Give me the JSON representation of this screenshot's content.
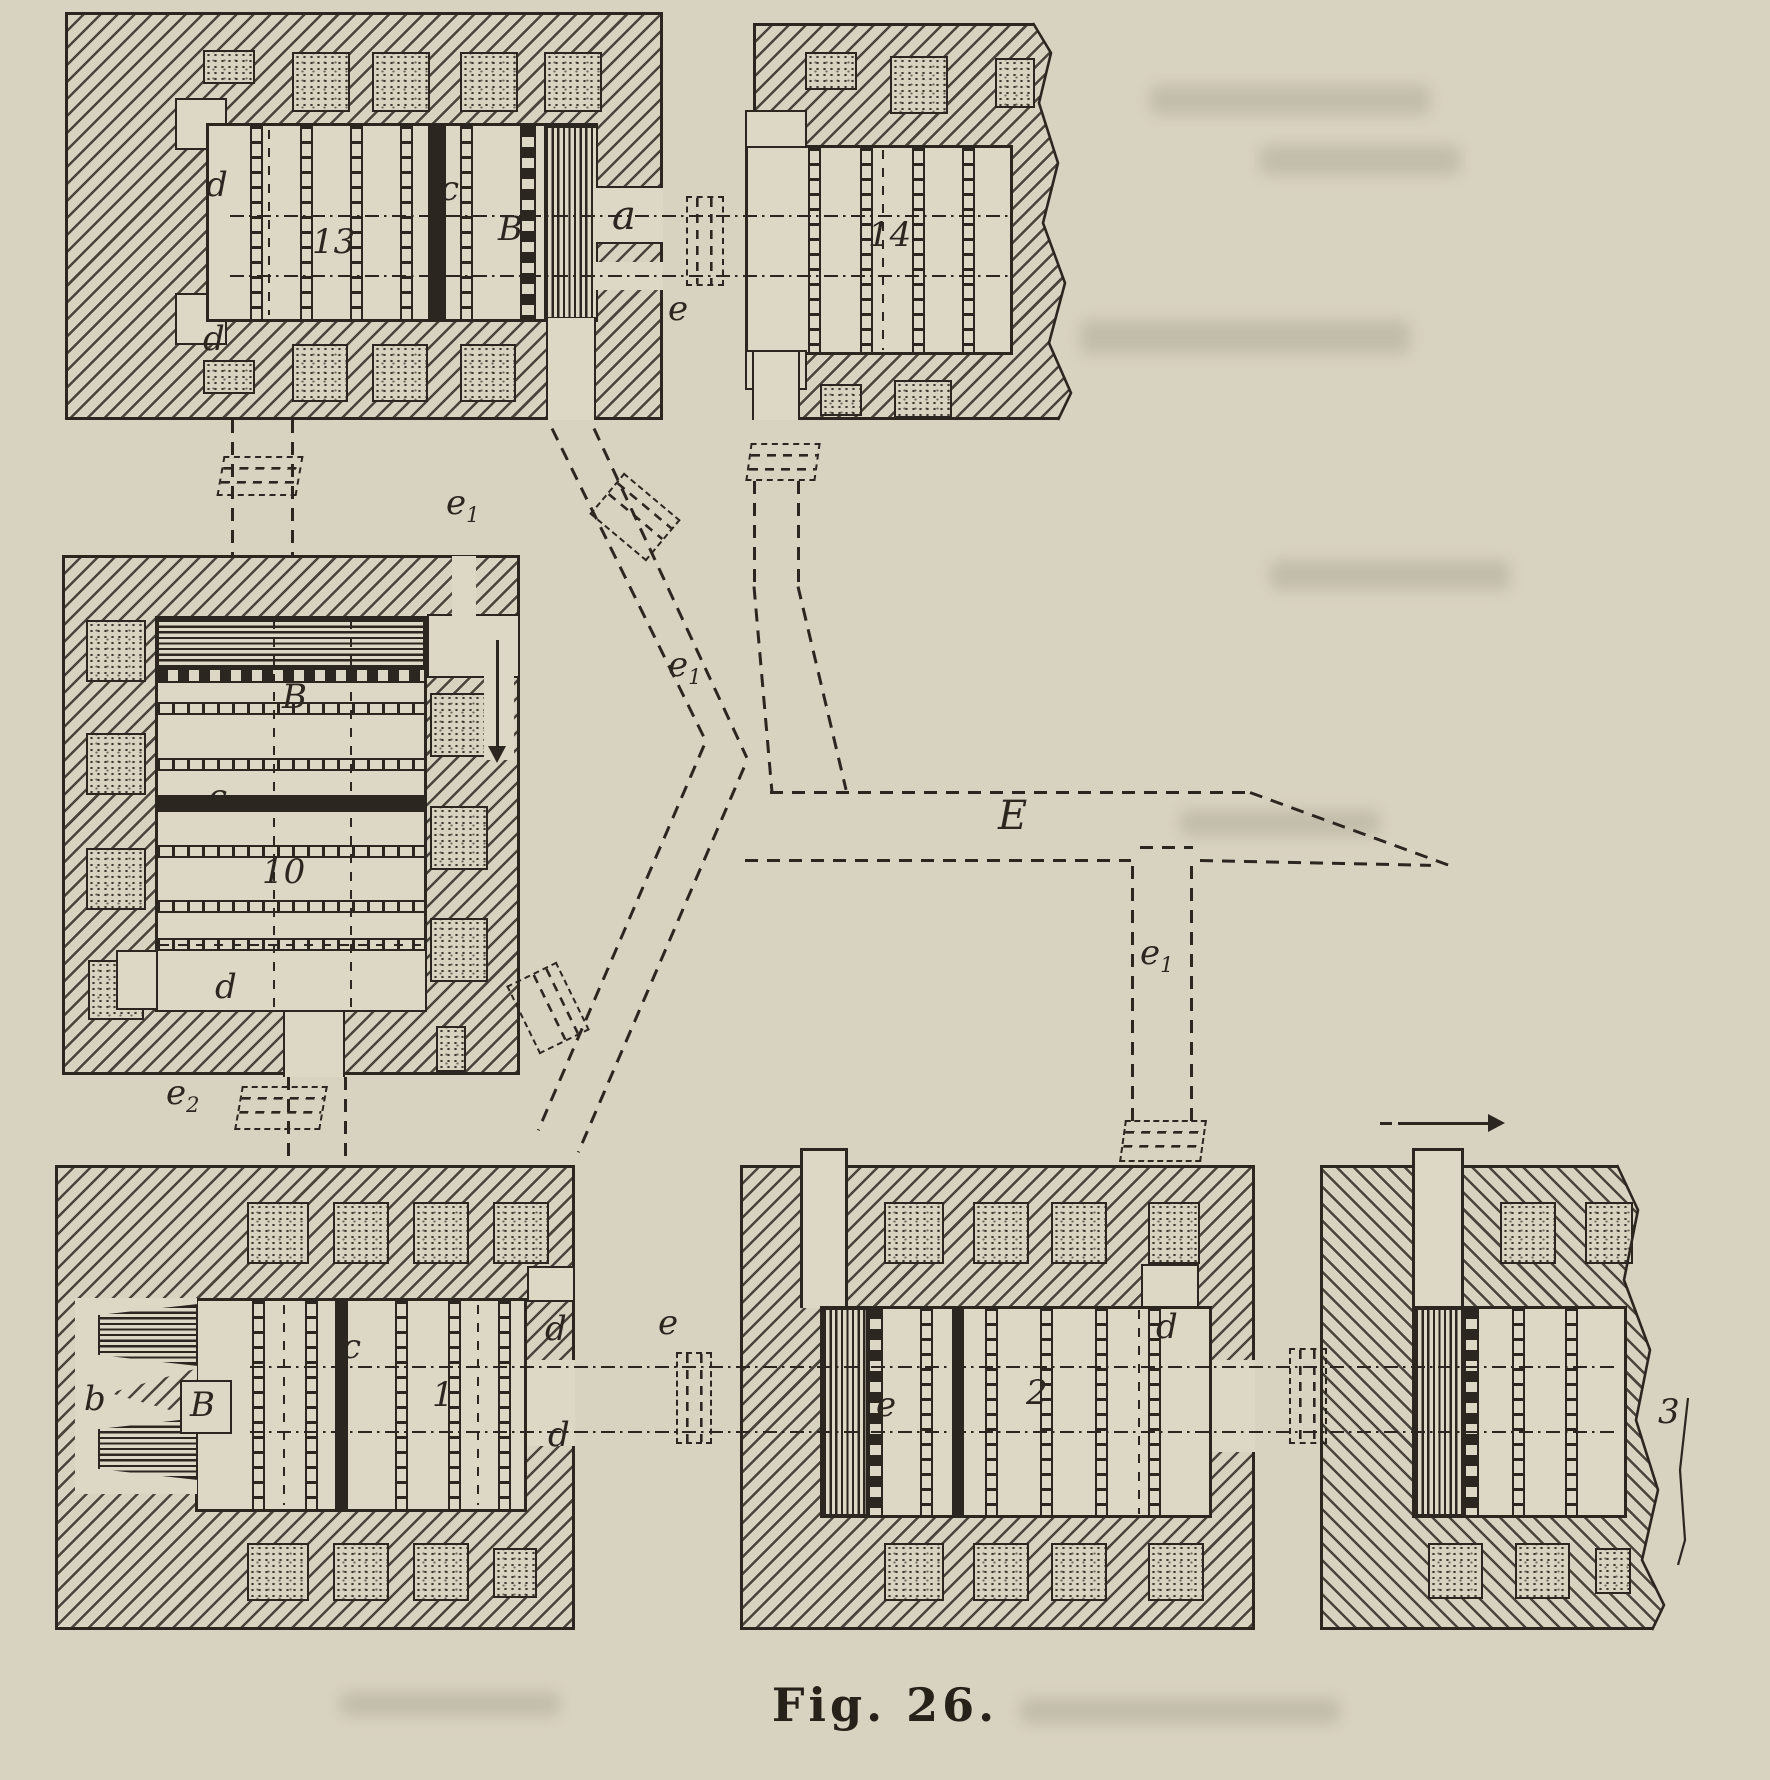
{
  "figure": {
    "caption": "Fig. 26."
  },
  "colors": {
    "paper": "#d8d2c0",
    "ink": "#2b2620"
  },
  "views": {
    "top_left": {
      "number": "13",
      "d_top": "d",
      "c": "c",
      "B": "B",
      "d_bottom": "d",
      "a": "a"
    },
    "top_right": {
      "number": "14"
    },
    "middle_left": {
      "number": "10",
      "B": "B",
      "c": "c",
      "d": "d"
    },
    "bottom_left": {
      "number": "1",
      "b": "b",
      "B": "B",
      "c": "c",
      "d_top": "d",
      "d_bottom": "d"
    },
    "bottom_middle": {
      "number": "2",
      "e": "e",
      "d": "d"
    },
    "bottom_right": {
      "number": "3"
    }
  },
  "network": {
    "e_top": "e",
    "e1": {
      "base": "e",
      "sub": "1"
    },
    "e2": {
      "base": "e",
      "sub": "2"
    },
    "main_gallery": "E",
    "e_bottom": "e"
  }
}
